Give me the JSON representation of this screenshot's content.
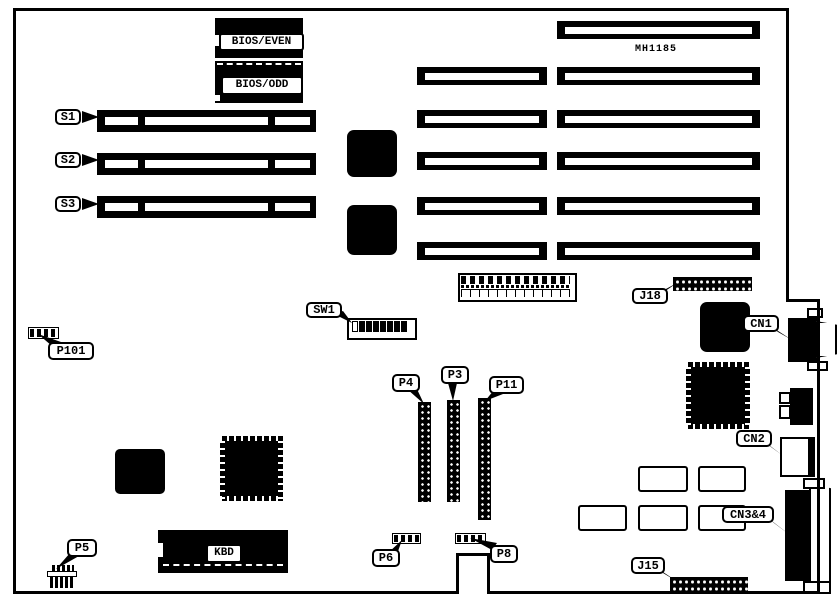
{
  "figure": {
    "kind": "motherboard component location diagram"
  },
  "annotations": {
    "board_part": "MH1185"
  },
  "chips": {
    "bios_even": "BIOS/EVEN",
    "bios_odd": "BIOS/ODD",
    "kbd": "KBD"
  },
  "callouts": {
    "s1": "S1",
    "s2": "S2",
    "s3": "S3",
    "sw1": "SW1",
    "p101": "P101",
    "p4": "P4",
    "p3": "P3",
    "p11": "P11",
    "p5": "P5",
    "p6": "P6",
    "p8": "P8",
    "j15": "J15",
    "j18": "J18",
    "cn1": "CN1",
    "cn2": "CN2",
    "cn34": "CN3&4"
  },
  "colors": {
    "ink": "#000000",
    "paper": "#ffffff"
  }
}
